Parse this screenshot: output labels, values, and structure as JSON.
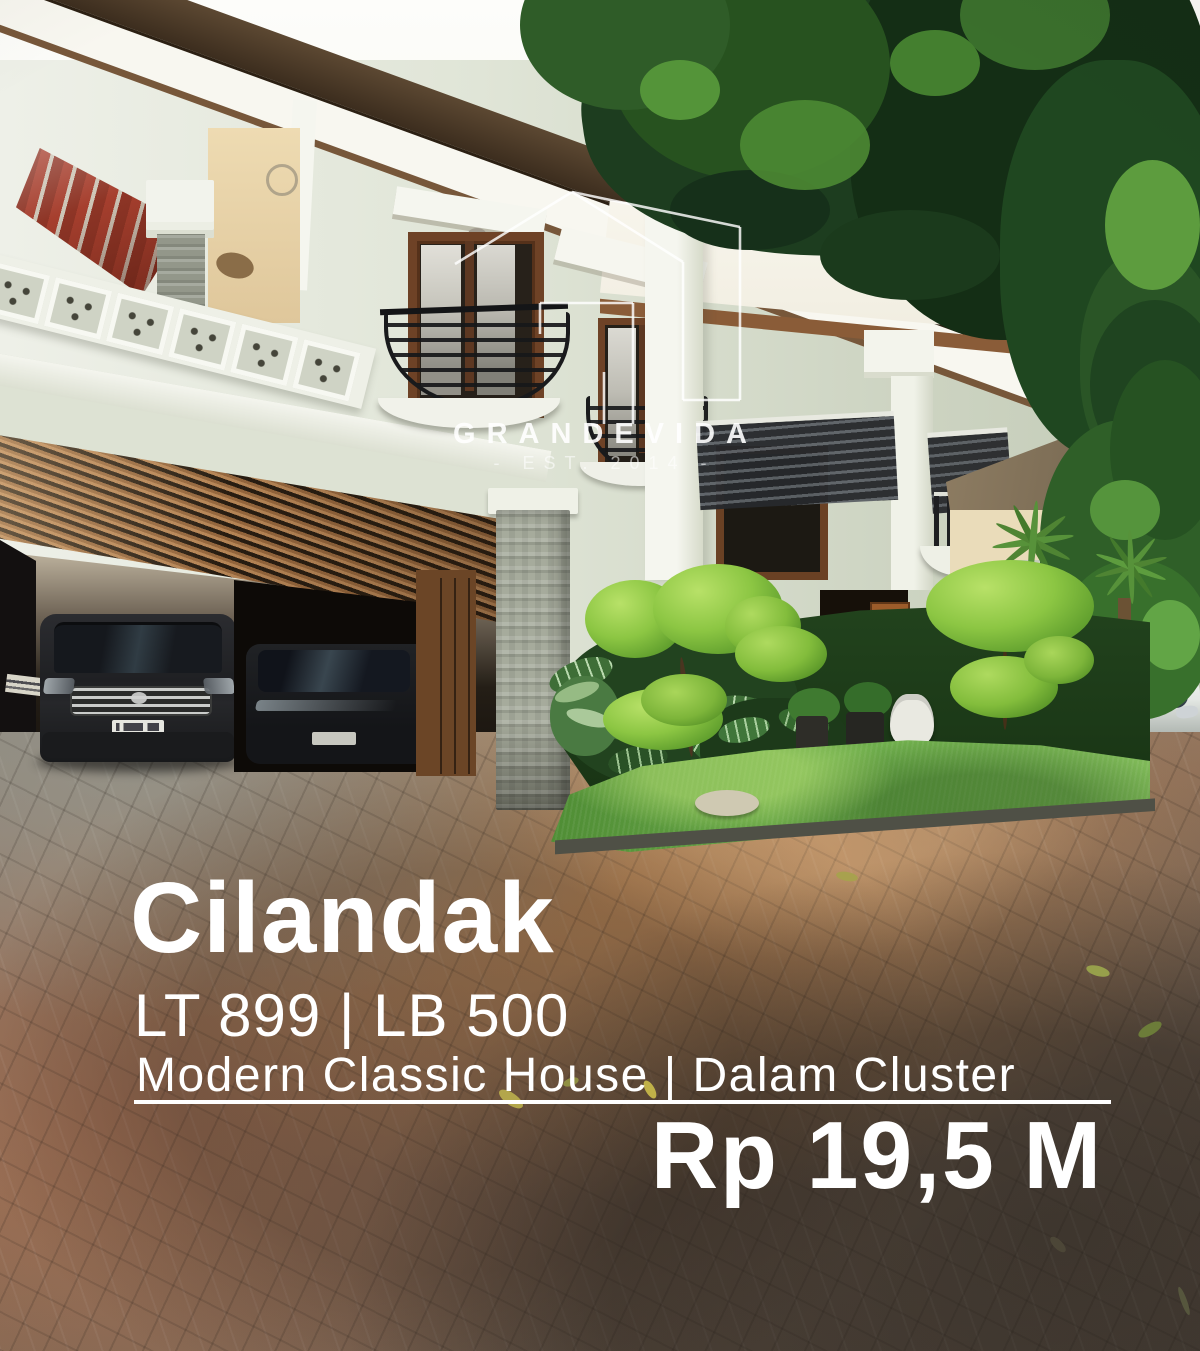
{
  "watermark": {
    "brand": "GRANDEVIDA",
    "established": "- EST. 2014 -",
    "logo_icon": "house-outline-icon",
    "color": "rgba(255,255,255,0.88)"
  },
  "listing": {
    "location": "Cilandak",
    "land_building": "LT 899 | LB 500",
    "description": "Modern Classic House | Dalam Cluster",
    "price": "Rp 19,5 M"
  },
  "overlay_colors": {
    "caption_text": "#ffffff",
    "divider_rule": "#ffffff"
  }
}
